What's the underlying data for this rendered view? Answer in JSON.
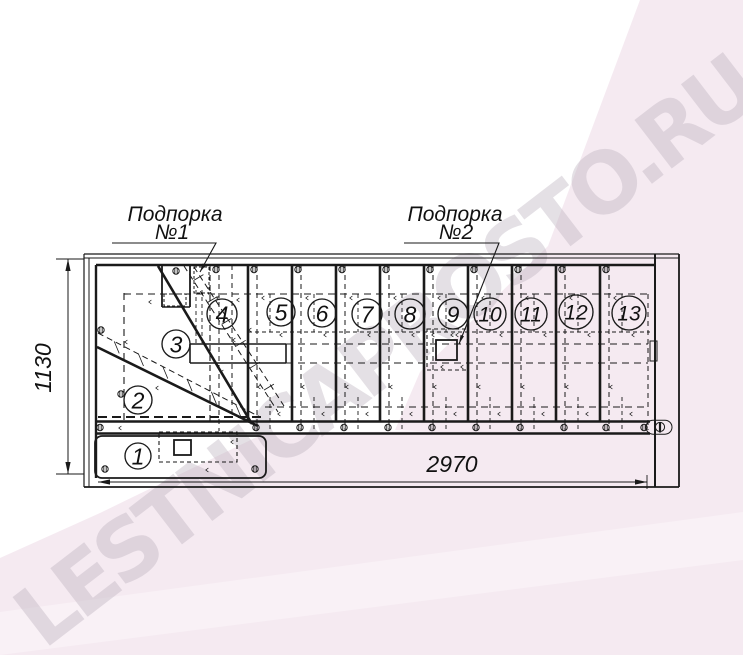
{
  "watermark": {
    "text": "LESTNICAPROSTO.RU"
  },
  "drawing": {
    "support_label_1": {
      "line1": "Подпорка",
      "line2": "№1"
    },
    "support_label_2": {
      "line1": "Подпорка",
      "line2": "№2"
    },
    "dimensions": {
      "width": "2970",
      "height": "1130"
    },
    "steps": [
      "1",
      "2",
      "3",
      "4",
      "5",
      "6",
      "7",
      "8",
      "9",
      "10",
      "11",
      "12",
      "13"
    ]
  },
  "colors": {
    "line": "#1a1a1a",
    "pink_band": "#f5eaf1",
    "pink_light": "#f9f1f6",
    "watermark_gray": "#bcb2be"
  }
}
